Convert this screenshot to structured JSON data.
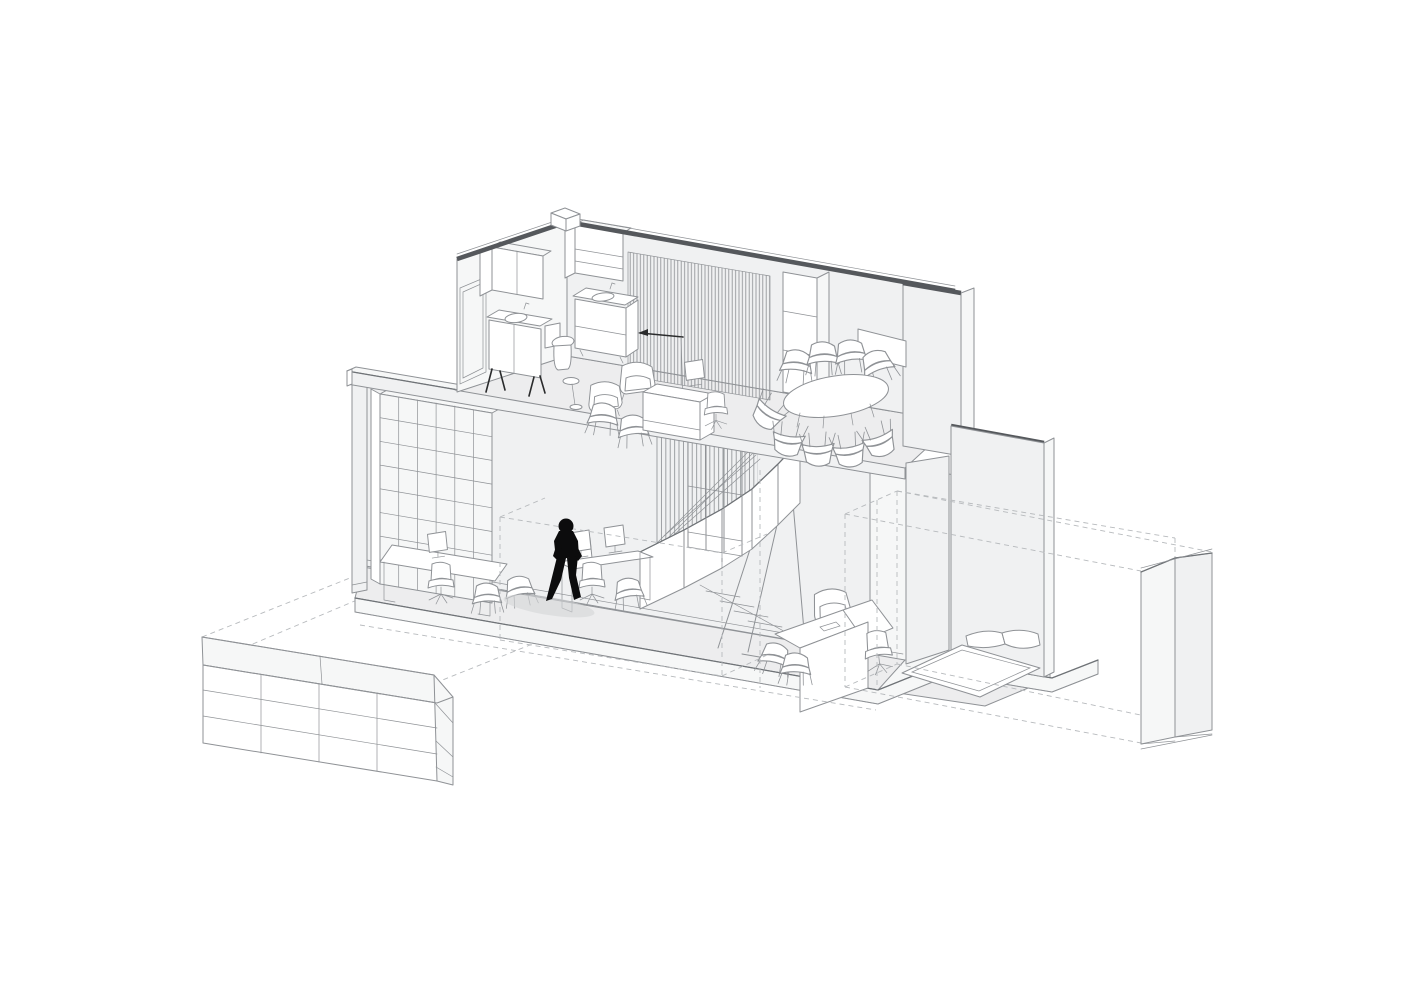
{
  "scene": {
    "kind": "architectural-axonometric-cutaway-drawing",
    "subject": "two-storey studio office interior, sectional axonometric with exploded parts",
    "background": "#ffffff"
  },
  "palette": {
    "paper": "#ffffff",
    "line": "#8f9296",
    "line-strong": "#6f7377",
    "guide": "#b7babd",
    "wall": "#f0f1f2",
    "wall-light": "#f6f7f7",
    "floor": "#ededee",
    "section-cut": "#55585c",
    "figure": "#0c0c0d",
    "shadow": "#d4d6d7",
    "ink": "#2a2b2c"
  },
  "elements": {
    "walking-figure": "black silhouette of a person walking on the ground floor",
    "figure-shadow": "soft grey cast shadow under the figure",
    "storage-lockers-unit": "low shelving / locker block shown on the dashed ground footprint, lower left",
    "detached-wall-panel": "exploded tall wall slab at far right linked with dashed projection lines",
    "ground-floor-plinth": "ground floor slab edge in section",
    "upper-floor-slab": "first floor slab edge in section",
    "roof-cut-caps": "dark poché caps on the tops of cut walls",
    "skylight-curb": "small roof curb box on the back wall top",
    "bookshelf-grid": "full-height open shelving grid on ground floor left wall",
    "ground-desk-left": "desk with monitor and office chair beside the bookshelf",
    "ground-desk-centre": "double desk with two monitors behind the walking figure",
    "staircase": "steel stair with folded-plate balustrade and slatted screen",
    "glazed-partition": "gridded glazing beside the stair void",
    "timber-slat-screen": "floor-to-ceiling timber slat screen on the upper floor",
    "wall-lamp": "long-arm wall lamp drawn with an arrowhead",
    "bathroom-group": "toilet, two wash basins and wall cabinets on the upper floor left",
    "bathroom-door-frame": "door opening drawn on the upper left end wall",
    "lounge-group": "lounge chairs, stool and side chairs on the upper floor",
    "credenza": "white storage cabinet with monitor on the upper floor",
    "upper-shelving": "tall shelf unit at the meeting room edge",
    "conference-table": "oval meeting table with eight chairs",
    "whiteboard": "board frame on the meeting room back wall",
    "structural-pier": "wall pier on the ground floor right bay",
    "right-bay-desk": "L-shaped desk with task chair and lounge chair, ground floor right",
    "entrance-mat": "recessed floor mat with cushions by the right wall",
    "dashed-guides": "dashed construction lines marking removed volumes and projections"
  }
}
